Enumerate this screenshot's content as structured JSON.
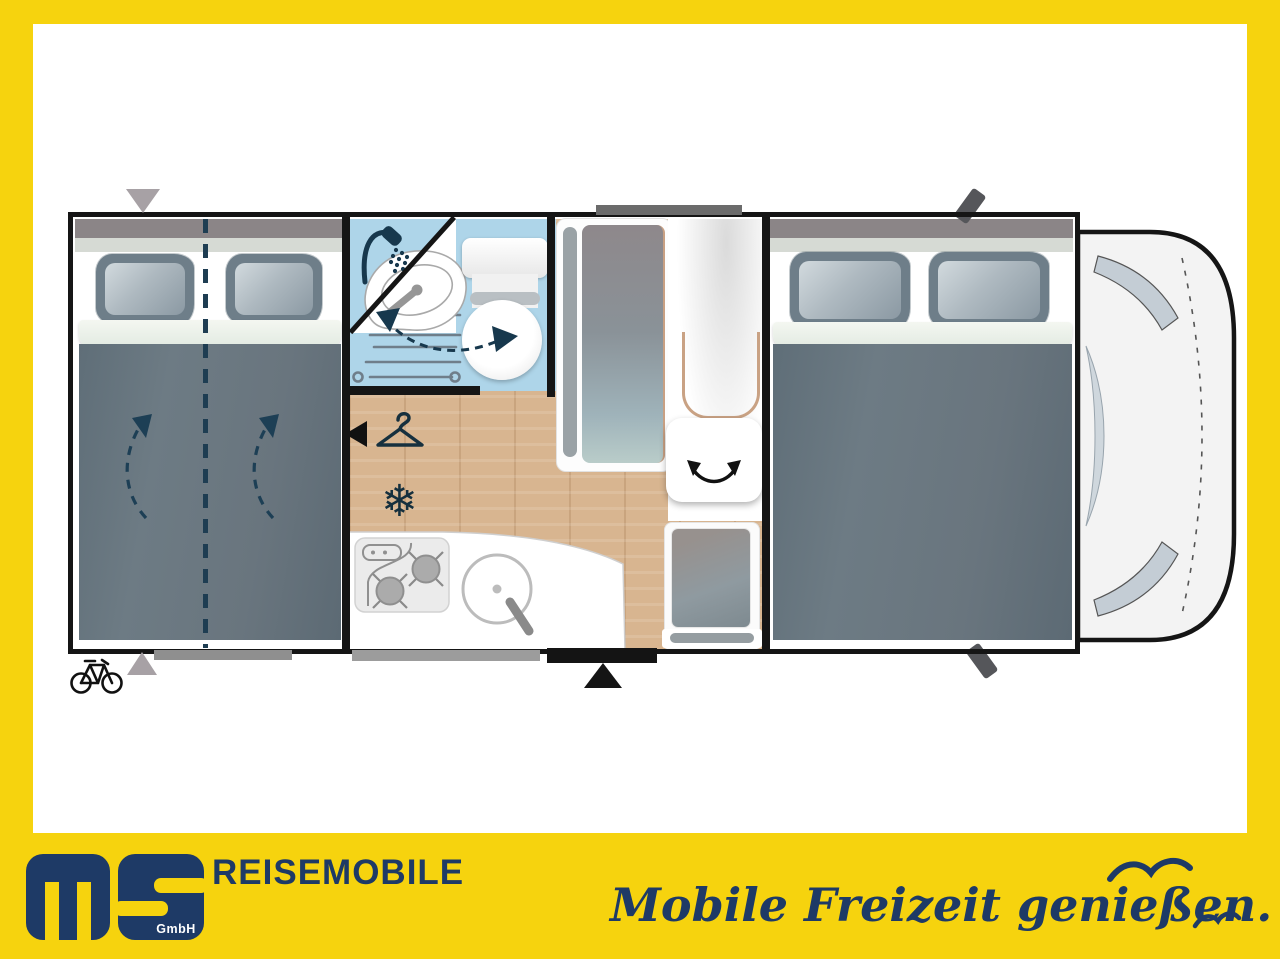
{
  "window": {
    "width": 1280,
    "height": 959
  },
  "colors": {
    "frame_yellow": "#f6d30e",
    "brand_navy": "#1e3a66",
    "plan_icon_navy": "#17384d",
    "wall_black": "#151515",
    "duvet_gray": "#68767f",
    "bathroom_blue": "#aed5e9",
    "wood_floor": "#d8b590",
    "cab_body": "#f3f3f3",
    "cab_glass": "#c4cdd5"
  },
  "footer": {
    "logo_letters": "ms",
    "logo_suffix": "GmbH",
    "brand_text": "REISEMOBILE",
    "tagline": "Mobile Freizeit genießen.",
    "icons": [
      "seagull-icon-large",
      "seagull-icon-small"
    ]
  },
  "floorplan": {
    "view": "motorhome top view, cab at right",
    "features": [
      {
        "name": "rear-double-bed",
        "icon": "split-line-and-turn-arrows"
      },
      {
        "name": "bathroom",
        "icon": "shower-icon"
      },
      {
        "name": "swivel-washbasin",
        "icon": "dashed-swivel-arrow"
      },
      {
        "name": "toilet"
      },
      {
        "name": "wardrobe",
        "icon": "hanger-icon"
      },
      {
        "name": "refrigerator",
        "icon": "snowflake-icon"
      },
      {
        "name": "kitchen",
        "icon": "two-burner-hob-and-sink"
      },
      {
        "name": "swivel-tv",
        "icon": "rotate-arrow"
      },
      {
        "name": "side-seat"
      },
      {
        "name": "entry-door",
        "icon": "black-triangle-marker"
      },
      {
        "name": "front-double-bed"
      },
      {
        "name": "driver-cab"
      },
      {
        "name": "rear-garage",
        "icon": "bicycle-icon"
      }
    ],
    "snowflake_glyph": "❄"
  }
}
